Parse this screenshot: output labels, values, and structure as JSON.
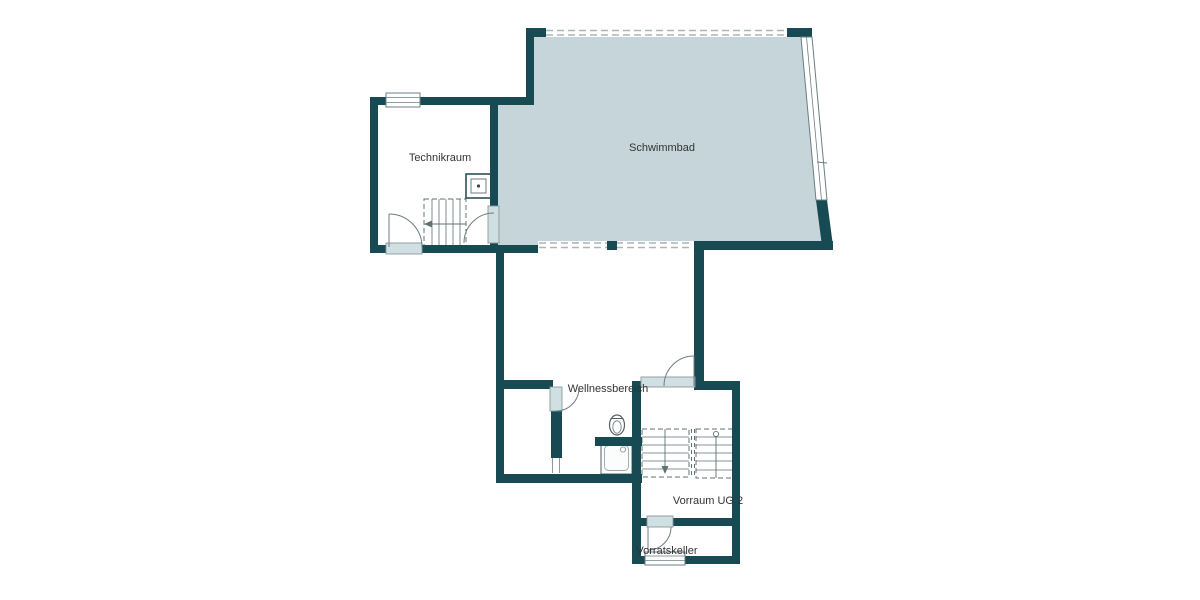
{
  "diagram_type": "floor-plan",
  "rooms": [
    {
      "id": "technikraum",
      "label": "Technikraum"
    },
    {
      "id": "schwimmbad",
      "label": "Schwimmbad"
    },
    {
      "id": "wellnessbereich",
      "label": "Wellnessbereich"
    },
    {
      "id": "vorraum-ug-2",
      "label": "Vorraum UG 2"
    },
    {
      "id": "vorratskeller",
      "label": "Vorratskeller"
    }
  ],
  "colors": {
    "wall": "#174a53",
    "pool_fill": "#c5d5d9",
    "door_panel": "#cfdfe2",
    "window_line": "#6b7d82",
    "dash_line": "#a9b6ba",
    "symbol_line": "#607074",
    "text": "#333333",
    "background": "#ffffff"
  }
}
